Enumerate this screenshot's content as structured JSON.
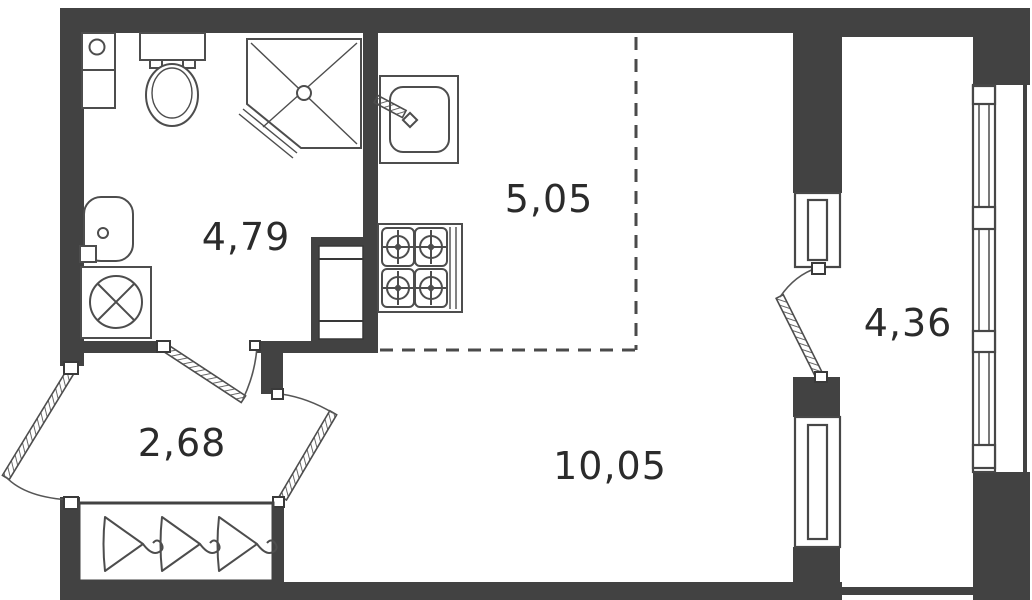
{
  "plan": {
    "title": "studio-apartment-floor-plan",
    "background_color": "#ffffff",
    "wall_color": "#424242",
    "line_color": "#4d4d4d",
    "text_color": "#2b2b2b",
    "rooms": [
      {
        "name": "bathroom",
        "area_label": "4,79",
        "area_value": 4.79
      },
      {
        "name": "kitchen-zone",
        "area_label": "5,05",
        "area_value": 5.05
      },
      {
        "name": "hallway",
        "area_label": "2,68",
        "area_value": 2.68
      },
      {
        "name": "living-zone",
        "area_label": "10,05",
        "area_value": 10.05
      },
      {
        "name": "balcony",
        "area_label": "4,36",
        "area_value": 4.36
      }
    ],
    "fixtures": [
      "toilet",
      "corner-shower",
      "washbasin",
      "washing-machine",
      "bathroom-cabinet",
      "kitchen-sink",
      "stove-4-burners",
      "ventilation-shaft",
      "wardrobe-with-hangers",
      "entrance-door",
      "bathroom-door",
      "living-room-door",
      "balcony-door",
      "balcony-windows",
      "balcony-glazing"
    ]
  }
}
